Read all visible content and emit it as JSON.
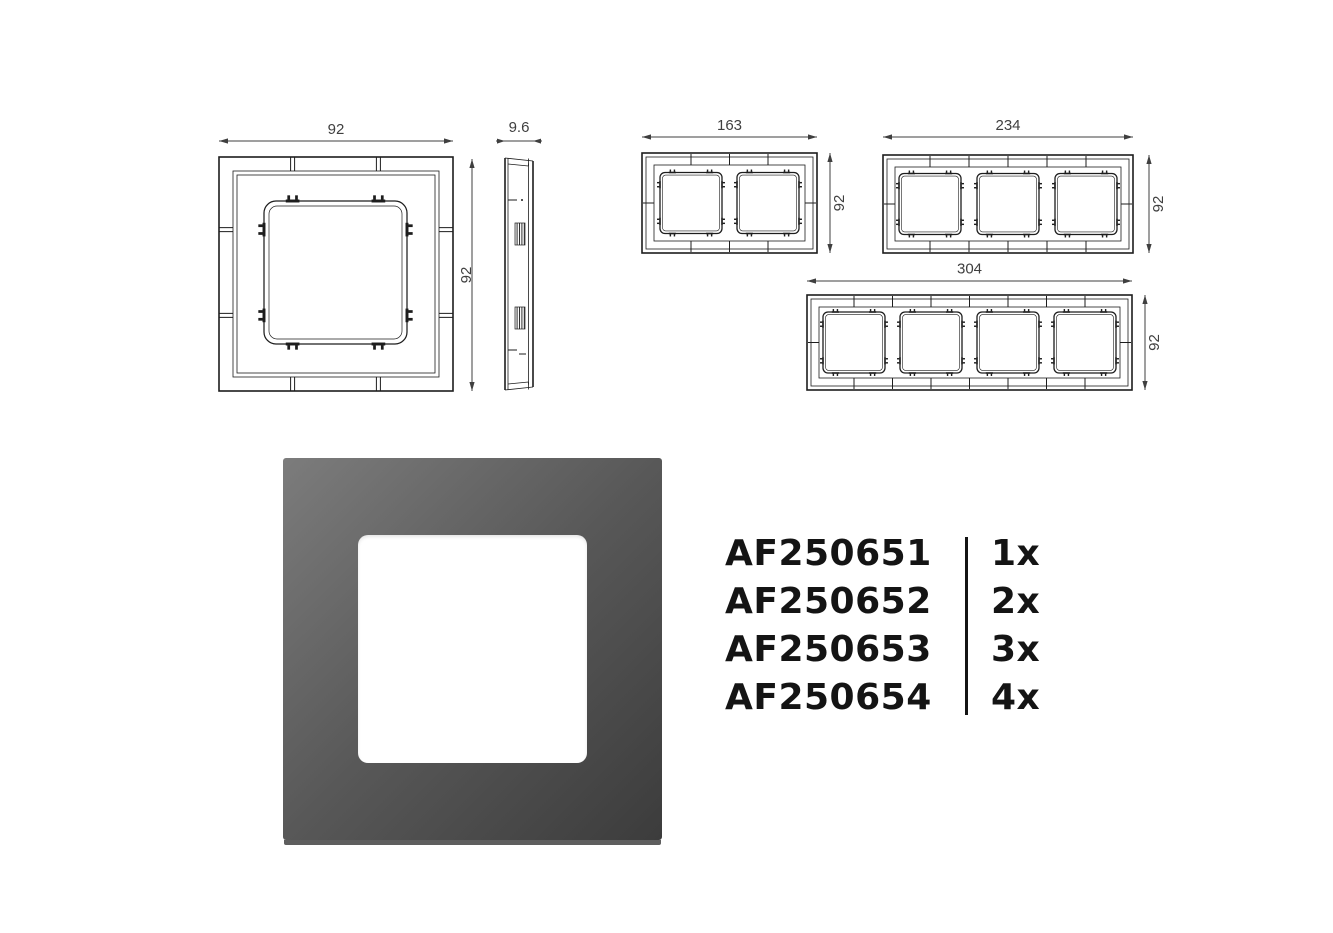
{
  "drawings": {
    "single_front": {
      "width_label": "92",
      "height_label": "92"
    },
    "side_profile": {
      "depth_label": "9.6"
    },
    "frame_2gang": {
      "width_label": "163",
      "height_label": "92"
    },
    "frame_3gang": {
      "width_label": "234",
      "height_label": "92"
    },
    "frame_4gang": {
      "width_label": "304",
      "height_label": "92"
    }
  },
  "product_list": {
    "rows": [
      {
        "code": "AF250651",
        "quantity": "1x"
      },
      {
        "code": "AF250652",
        "quantity": "2x"
      },
      {
        "code": "AF250653",
        "quantity": "3x"
      },
      {
        "code": "AF250654",
        "quantity": "4x"
      }
    ]
  },
  "render": {
    "gradient_top_left": "#7c7c7c",
    "gradient_mid": "#585858",
    "gradient_bottom_right": "#3c3c3c",
    "opening_color": "#ffffff",
    "bottom_edge_color": "#5e5e5e"
  },
  "drawing_style": {
    "line_color": "#1d1d1d",
    "dimension_color": "#3f3f3f"
  }
}
